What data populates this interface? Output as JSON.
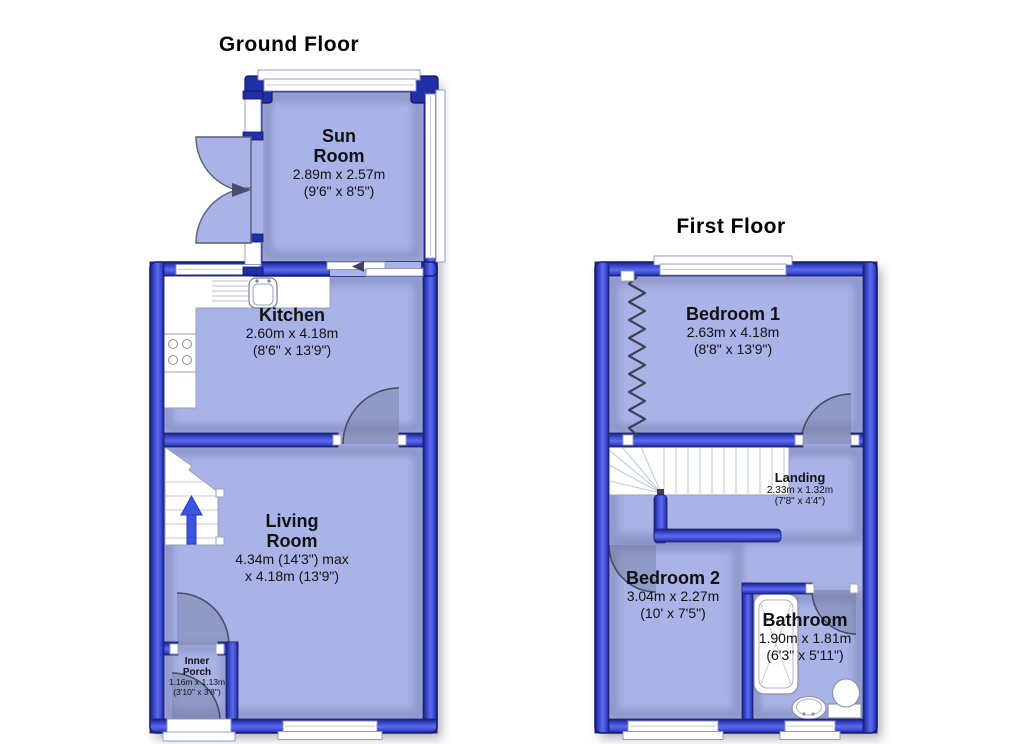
{
  "ground_floor": {
    "title": "Ground Floor",
    "rooms": {
      "sun_room": {
        "name_line1": "Sun",
        "name_line2": "Room",
        "metric": "2.89m x 2.57m",
        "imperial": "(9'6\" x 8'5\")"
      },
      "kitchen": {
        "name": "Kitchen",
        "metric": "2.60m x 4.18m",
        "imperial": "(8'6\" x 13'9\")"
      },
      "living_room": {
        "name_line1": "Living",
        "name_line2": "Room",
        "metric_line1": "4.34m (14'3\") max",
        "metric_line2": "x 4.18m (13'9\")"
      },
      "inner_porch": {
        "name_line1": "Inner",
        "name_line2": "Porch",
        "metric": "1.16m x 1.13m",
        "imperial": "(3'10\" x 3'8\")"
      }
    }
  },
  "first_floor": {
    "title": "First Floor",
    "rooms": {
      "bedroom_1": {
        "name": "Bedroom 1",
        "metric": "2.63m x 4.18m",
        "imperial": "(8'8\" x 13'9\")"
      },
      "landing": {
        "name": "Landing",
        "metric": "2.33m x 1.32m",
        "imperial": "(7'8\" x 4'4\")"
      },
      "bedroom_2": {
        "name": "Bedroom 2",
        "metric": "3.04m x 2.27m",
        "imperial": "(10' x 7'5\")"
      },
      "bathroom": {
        "name": "Bathroom",
        "metric": "1.90m x 1.81m",
        "imperial": "(6'3\" x 5'11\")"
      }
    }
  },
  "colors": {
    "wall": "#3a49d4",
    "wall_outline": "#141b70",
    "wall_highlight": "#5e6be8",
    "floor": "#a9b3e8",
    "window": "#ffffff",
    "door_swing_shade": "#69708f",
    "stairs_arrow": "#3c55e0",
    "text": "#111111"
  },
  "icons": {
    "stairs_arrow": "up-arrow",
    "sun_room_doors": "double-door-swing"
  }
}
